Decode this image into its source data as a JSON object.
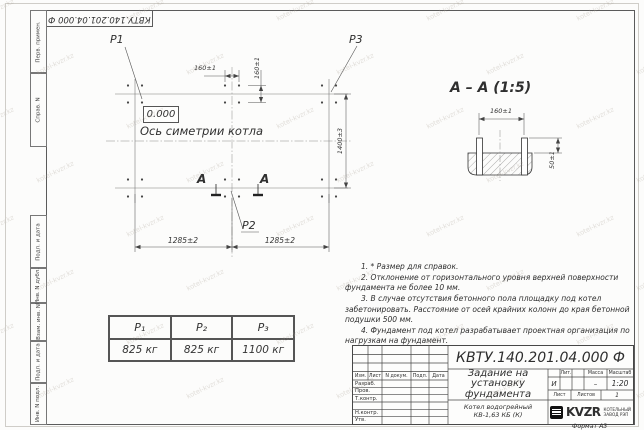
{
  "frame": {
    "top_left_number": "КВТУ.140.201.04.000 Ф",
    "side_columns": [
      "Перв. примен.",
      "Справ. N",
      "Подп. и дата",
      "Инв. N дубл.",
      "Взам. инв. N",
      "Подп. и дата",
      "Инв. N подл."
    ],
    "format_label": "Формат А3"
  },
  "watermark": "kotel-kvzr.kz",
  "plan": {
    "p1": "P1",
    "p2": "P2",
    "p3": "P3",
    "elevation": "0.000",
    "axis_label": "Ось симетрии котла",
    "section_letter_left": "А",
    "section_letter_right": "А",
    "dim_bolt_horizontal": "160±1",
    "dim_bolt_vertical": "160±1",
    "dim_span_left": "1285±2",
    "dim_span_right": "1285±2",
    "dim_depth": "1400±3"
  },
  "section": {
    "title": "А – А (1:5)",
    "dim_bolt_spacing": "160±1",
    "dim_protrusion": "50±1"
  },
  "notes": [
    "1. * Размер для справок.",
    "2. Отклонение от горизонтального уровня верхней поверхности фундамента не более 10 мм.",
    "3. В случае отсутствия бетонного пола площадку под котел забетонировать. Расстояние от осей крайних колонн до края бетонной подушки 500 мм.",
    "4. Фундамент под котел разрабатывает проектная организация по нагрузкам на фундамент."
  ],
  "load_table": {
    "headers": [
      "P₁",
      "P₂",
      "P₃"
    ],
    "values": [
      "825 кг",
      "825 кг",
      "1100 кг"
    ]
  },
  "title_block": {
    "doc_number": "КВТУ.140.201.04.000 Ф",
    "title": "Задание на установку фундамента",
    "product": "Котел водогрейный КВ-1,63 КБ (К)",
    "col_izm": "Изм.",
    "col_list": "Лист",
    "col_doc": "N докум.",
    "col_sign": "Подп.",
    "col_date": "Дата",
    "row_razrab": "Разраб.",
    "row_prov": "Пров.",
    "row_tkontr": "Т.контр.",
    "row_nkontr": "Н.контр.",
    "row_utv": "Утв.",
    "lit_label": "Лит.",
    "mass_label": "Масса",
    "scale_label": "Масштаб",
    "lit_value": "И",
    "mass_value": "–",
    "scale_value": "1:20",
    "sheet_label": "Лист",
    "sheets_label": "Листов",
    "sheets_value": "1",
    "logo_text": "KVZR",
    "logo_caption1": "КОТЕЛЬНЫЙ",
    "logo_caption2": "ЗАВОД РЭП"
  }
}
